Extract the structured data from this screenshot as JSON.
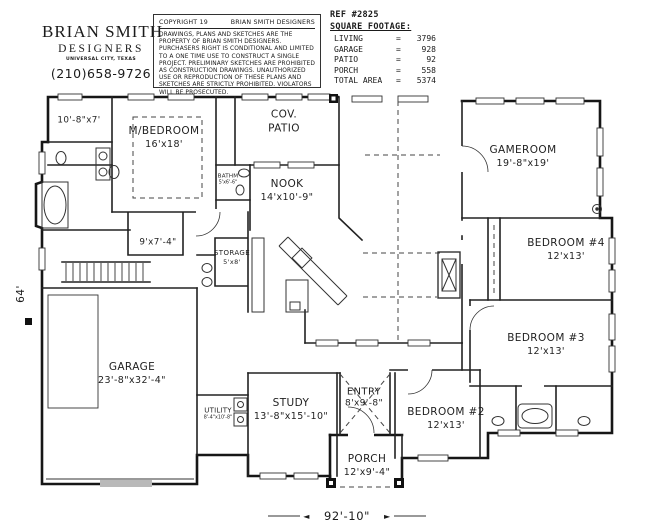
{
  "header": {
    "firm_name": "BRIAN SMITH",
    "firm_subtitle": "DESIGNERS",
    "firm_location": "UNIVERSAL CITY, TEXAS",
    "firm_phone": "(210)658-9726",
    "copyright_line": "COPYRIGHT 19",
    "copyright_owner": "BRIAN SMITH DESIGNERS",
    "disclaimer": "DRAWINGS, PLANS AND SKETCHES ARE THE PROPERTY OF BRIAN SMITH DESIGNERS. PURCHASERS RIGHT IS CONDITIONAL AND LIMITED TO A ONE TIME USE TO CONSTRUCT A SINGLE PROJECT. PRELIMINARY SKETCHES ARE PROHIBITED AS CONSTRUCTION DRAWINGS. UNAUTHORIZED USE OR REPRODUCTION OF THESE PLANS AND SKETCHES ARE STRICTLY PROHIBITED. VIOLATORS WILL BE PROSECUTED."
  },
  "reference": {
    "ref_label": "REF #2825",
    "table_title": "SQUARE FOOTAGE:",
    "equals_sign": "=",
    "rows": [
      {
        "label": "LIVING",
        "value": "3796"
      },
      {
        "label": "GARAGE",
        "value": "928"
      },
      {
        "label": "PATIO",
        "value": "92"
      },
      {
        "label": "PORCH",
        "value": "558"
      },
      {
        "label": "TOTAL AREA",
        "value": "5374"
      }
    ]
  },
  "rooms": {
    "master_closet": {
      "dims": "10'-8\"x7'"
    },
    "master_bedroom": {
      "name": "M/BEDROOM",
      "dims": "16'x18'"
    },
    "cov_patio": {
      "line1": "COV.",
      "line2": "PATIO"
    },
    "nook": {
      "name": "NOOK",
      "dims": "14'x10'-9\""
    },
    "master_bath": {
      "name": "BATHM",
      "dims": "5'x6'-6\""
    },
    "sitting_room": {
      "dims": "9'x7'-4\""
    },
    "storage": {
      "name": "STORAGE",
      "dims": "5'x8'"
    },
    "gameroom": {
      "name": "GAMEROOM",
      "dims": "19'-8\"x19'"
    },
    "bedroom_4": {
      "name": "BEDROOM #4",
      "dims": "12'x13'"
    },
    "bedroom_3": {
      "name": "BEDROOM #3",
      "dims": "12'x13'"
    },
    "bedroom_2": {
      "name": "BEDROOM #2",
      "dims": "12'x13'"
    },
    "garage": {
      "name": "GARAGE",
      "dims": "23'-8\"x32'-4\""
    },
    "utility": {
      "name": "UTILITY",
      "dims": "8'-4\"x10'-8\""
    },
    "study": {
      "name": "STUDY",
      "dims": "13'-8\"x15'-10\""
    },
    "entry": {
      "name": "ENTRY",
      "dims": "8'x9'-8\""
    },
    "porch": {
      "name": "PORCH",
      "dims": "12'x9'-4\""
    }
  },
  "plan_dimensions": {
    "overall_width": "92'-10\"",
    "overall_height": "64'",
    "arrow_left": "◄",
    "arrow_right": "►"
  },
  "colors": {
    "line": "#1a1a1a",
    "background": "#ffffff"
  }
}
